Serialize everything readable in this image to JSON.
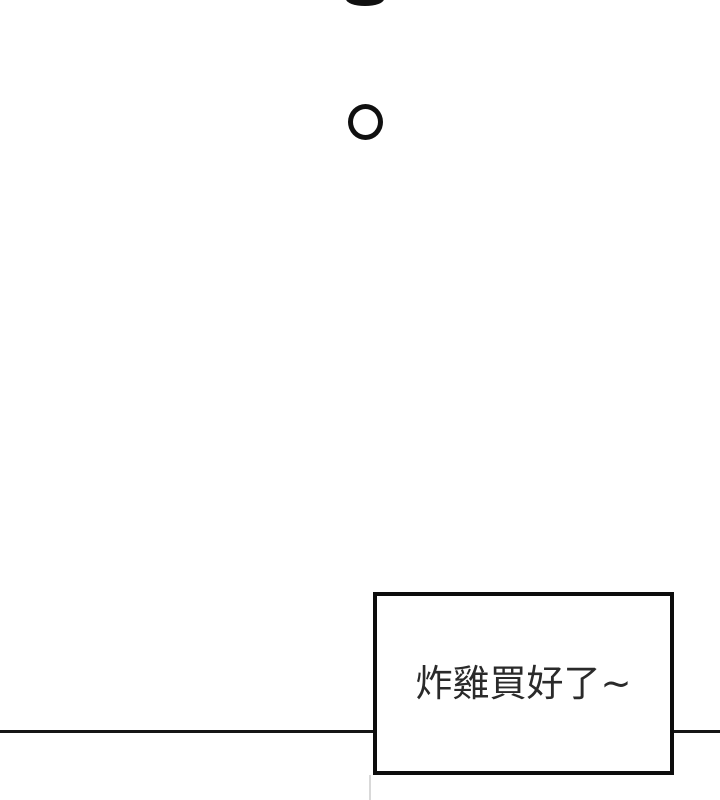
{
  "colors": {
    "background": "#ffffff",
    "ink": "#101010",
    "divider_line": "#161616",
    "bubble_border": "#0d0d0d",
    "bubble_text": "#2a2a2a",
    "faint_panel_line": "#d9d9d9"
  },
  "speech_bubble": {
    "text": "炸雞買好了~"
  }
}
